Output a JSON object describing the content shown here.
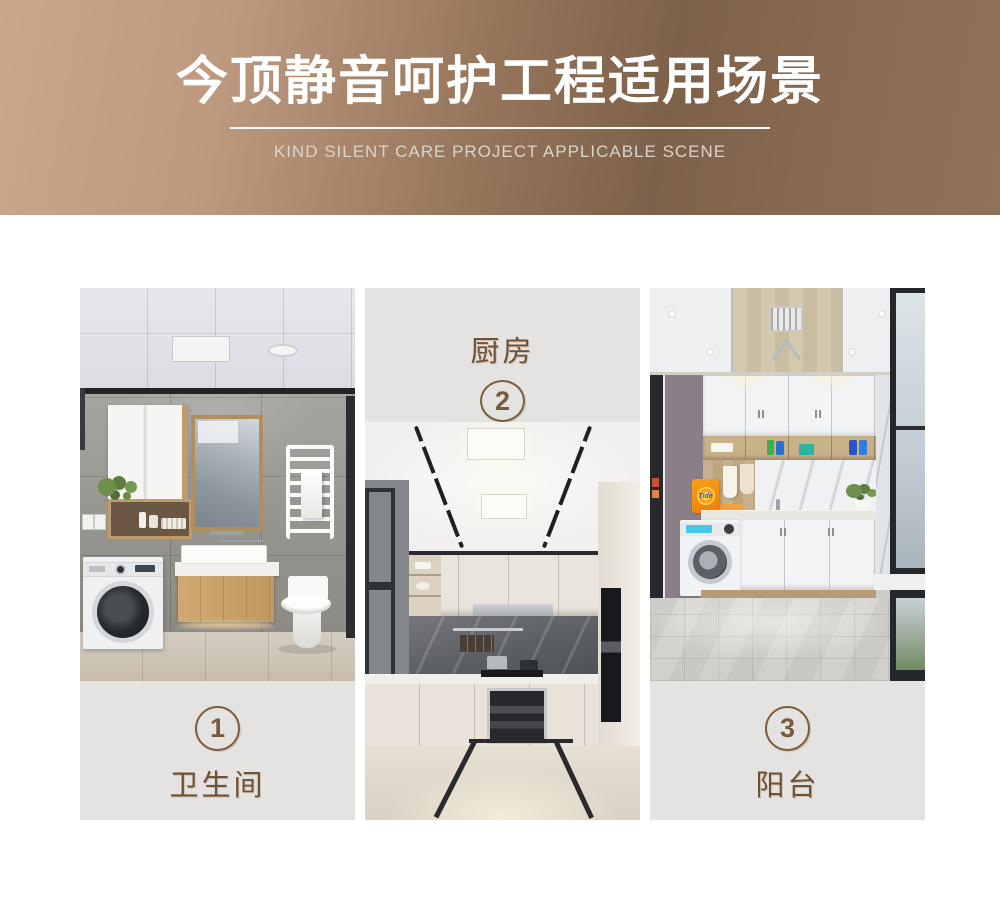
{
  "banner": {
    "title": "今顶静音呵护工程适用场景",
    "subtitle": "KIND SILENT CARE PROJECT APPLICABLE SCENE"
  },
  "scenes": [
    {
      "id": "bathroom",
      "number": "1",
      "label": "卫生间"
    },
    {
      "id": "kitchen",
      "number": "2",
      "label": "厨房"
    },
    {
      "id": "balcony",
      "number": "3",
      "label": "阳台",
      "tide_brand": "Tide"
    }
  ],
  "style": {
    "banner_gradient_left": "#c9a68c",
    "banner_gradient_dark": "#7e614a",
    "banner_gradient_right": "#917258",
    "accent_brown": "#7e5d3d",
    "label_text_color": "#6f5133",
    "label_bg": "#e4e3e1"
  }
}
